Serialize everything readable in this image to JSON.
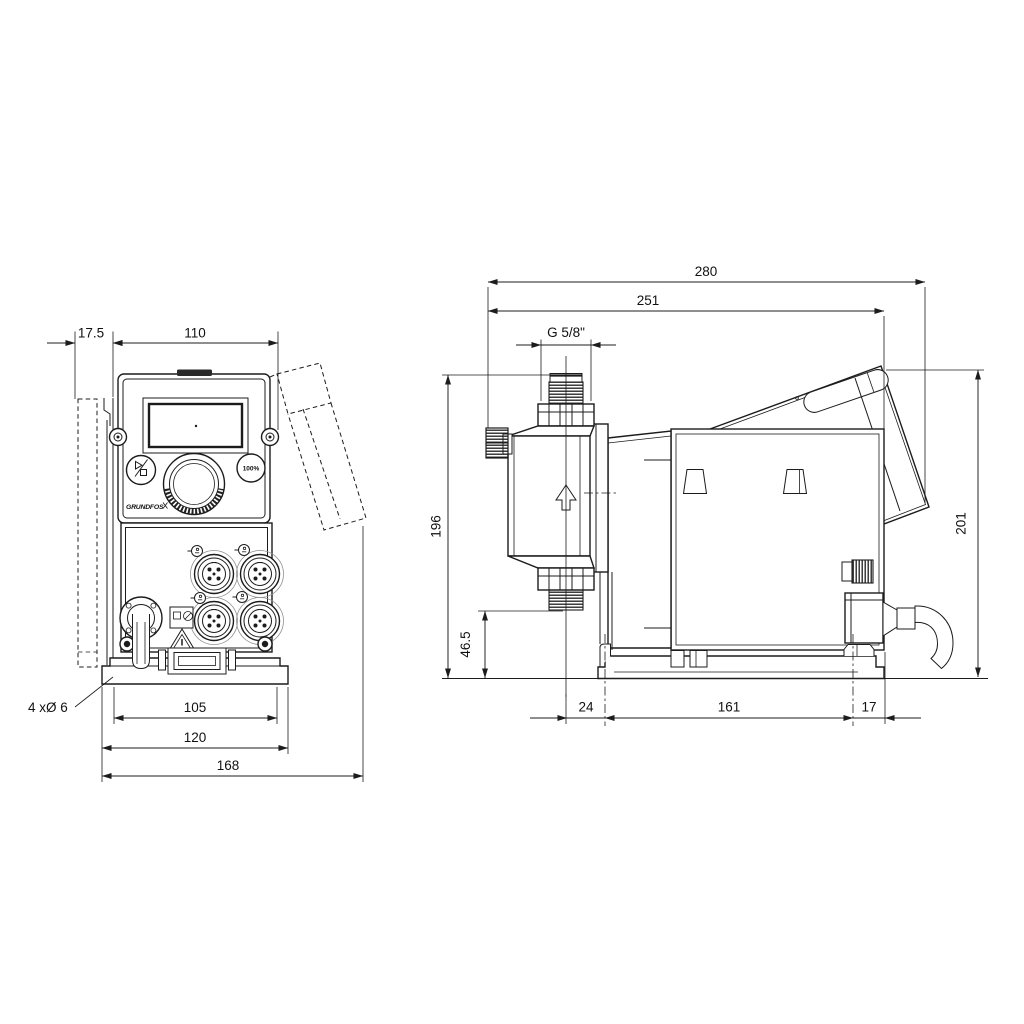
{
  "front": {
    "dim_wall_offset": "17.5",
    "dim_width": "110",
    "note_holes": "4 xØ 6",
    "dim_hole_spacing": "105",
    "dim_foot_width": "120",
    "dim_total_width": "168",
    "logo": "GRUNDFOS",
    "btn_percent": "100%"
  },
  "side": {
    "dim_total_depth": "280",
    "dim_depth": "251",
    "dim_thread": "G 5/8\"",
    "dim_height": "196",
    "dim_valve_height": "46.5",
    "dim_front_offset": "24",
    "dim_foot_length": "161",
    "dim_back_offset": "17",
    "dim_total_height": "201"
  }
}
